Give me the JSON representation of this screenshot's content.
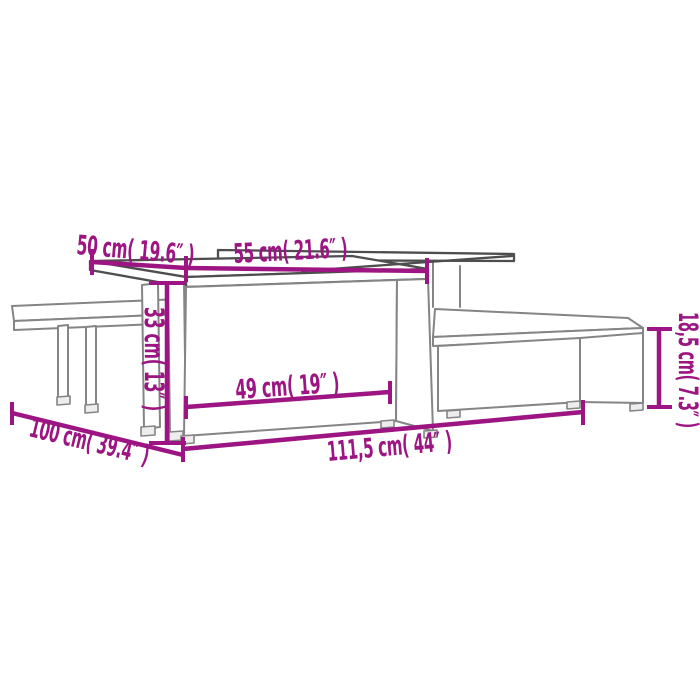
{
  "image": {
    "kind": "product-dimension-diagram",
    "subject": "nesting coffee tables line drawing",
    "background": "#ffffff"
  },
  "colors": {
    "dim": "#9C1583",
    "g1": "#858585",
    "g2": "#4e4e4e"
  },
  "dimensions": [
    {
      "id": "top-depth",
      "label": "50 cm( 19.6″ )"
    },
    {
      "id": "top-width",
      "label": "55 cm( 21.6″ )"
    },
    {
      "id": "tall-height",
      "label": "33 cm( 13″ )"
    },
    {
      "id": "lower-width",
      "label": "49 cm( 19″ )"
    },
    {
      "id": "total-depth",
      "label": "100 cm( 39.4″ )"
    },
    {
      "id": "total-width",
      "label": "111,5 cm( 44″ )"
    },
    {
      "id": "low-height",
      "label": "18,5 cm( 7.3″ )"
    }
  ]
}
